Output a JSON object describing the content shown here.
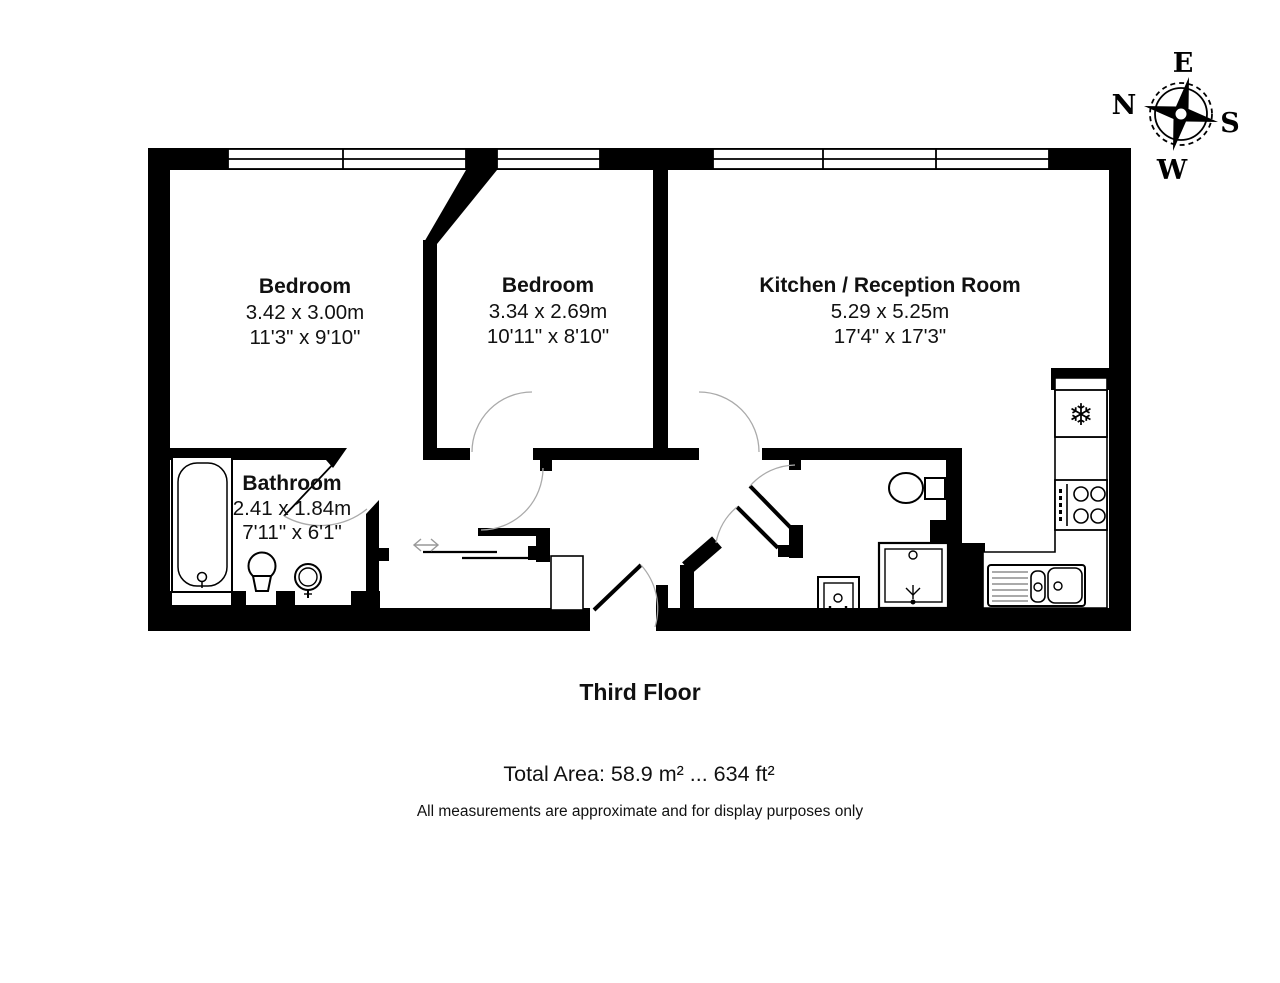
{
  "compass": {
    "north": "N",
    "east": "E",
    "south": "S",
    "west": "W"
  },
  "rooms": [
    {
      "name": "Bedroom",
      "metric": "3.42 x 3.00m",
      "imperial": "11'3\" x 9'10\""
    },
    {
      "name": "Bedroom",
      "metric": "3.34 x 2.69m",
      "imperial": "10'11\" x 8'10\""
    },
    {
      "name": "Kitchen / Reception Room",
      "metric": "5.29 x 5.25m",
      "imperial": "17'4\" x 17'3\""
    },
    {
      "name": "Bathroom",
      "metric": "2.41 x 1.84m",
      "imperial": "7'11\" x 6'1\""
    }
  ],
  "floor": {
    "label": "Third Floor"
  },
  "footer": {
    "total_area": "Total Area: 58.9 m² ... 634 ft²",
    "disclaimer": "All measurements are approximate and for display purposes only"
  },
  "icons": {
    "fridge_glyph": "❄"
  },
  "colors": {
    "wall": "#000000",
    "background": "#ffffff",
    "door_arc": "#aaaaaa"
  }
}
